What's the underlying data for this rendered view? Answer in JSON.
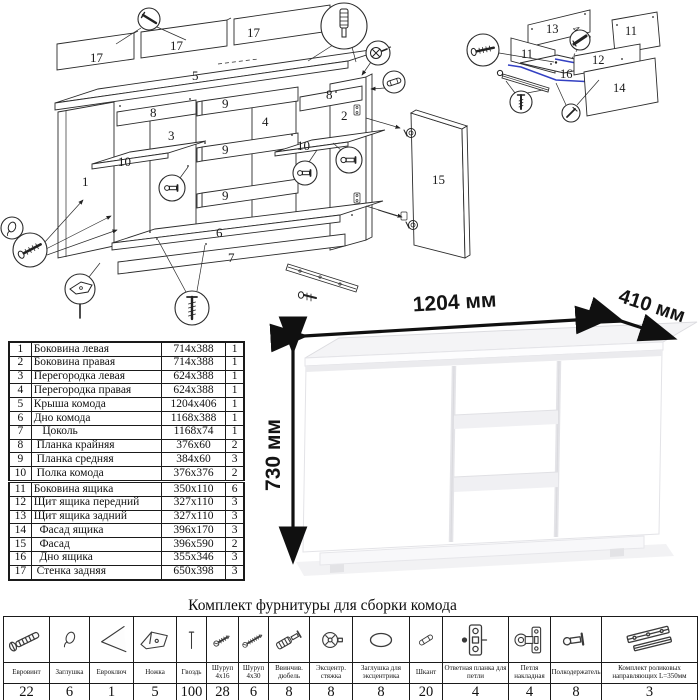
{
  "exploded_view": {
    "part_labels": {
      "back_a": "17",
      "back_b": "17",
      "back_c": "17",
      "top": "5",
      "side_left": "1",
      "side_right": "2",
      "partition_left": "3",
      "partition_right": "4",
      "bottom": "6",
      "plinth": "7",
      "bar_left": "8",
      "bar_right": "8",
      "rail_a": "9",
      "rail_b": "9",
      "rail_c": "9",
      "shelf_left": "10",
      "shelf_right": "10",
      "door": "15"
    },
    "callout_icons": [
      "nail-icon",
      "threaded-dowel-icon",
      "eccentric-cam-icon",
      "wood-dowel-icon",
      "shelf-pin-icon",
      "cap-icon",
      "euro-screw-icon",
      "foot-icon",
      "screw-icon",
      "roller-rail-icon",
      "hinge-icon"
    ]
  },
  "drawer_view": {
    "part_labels": {
      "back": "13",
      "side_left": "11",
      "side_right": "11",
      "front_shield": "12",
      "bottom": "16",
      "facade": "14"
    },
    "screw_note": "4х30",
    "accent_color": "#3340c2",
    "callout_icons": [
      "euro-screw-icon",
      "screw-icon",
      "nail-icon",
      "roller-rail-icon"
    ]
  },
  "render": {
    "width_label": "1204 мм",
    "depth_label": "410 мм",
    "height_label": "730 мм"
  },
  "parts_table": {
    "rows": [
      [
        "1",
        "Боковина левая",
        "714x388",
        "1"
      ],
      [
        "2",
        "Боковина правая",
        "714x388",
        "1"
      ],
      [
        "3",
        "Перегородка левая",
        "624x388",
        "1"
      ],
      [
        "4",
        "Перегородка правая",
        "624x388",
        "1"
      ],
      [
        "5",
        "Крыша комода",
        "1204x406",
        "1"
      ],
      [
        "6",
        "Дно комода",
        "1168x388",
        "1"
      ],
      [
        "7",
        "   Цоколь",
        "1168x74",
        "1"
      ],
      [
        "8",
        " Планка крайняя",
        "376x60",
        "2"
      ],
      [
        "9",
        " Планка средняя",
        "384x60",
        "3"
      ],
      [
        "10",
        " Полка комода",
        "376x376",
        "2"
      ],
      [
        "11",
        "Боковина ящика",
        "350x110",
        "6"
      ],
      [
        "12",
        "Щит ящика передний",
        "327x110",
        "3"
      ],
      [
        "13",
        "Щит ящика задний",
        "327x110",
        "3"
      ],
      [
        "14",
        "  Фасад ящика",
        "396x170",
        "3"
      ],
      [
        "15",
        "  Фасад",
        "396x590",
        "2"
      ],
      [
        "16",
        "  Дно ящика",
        "355x346",
        "3"
      ],
      [
        "17",
        " Стенка задняя",
        "650x398",
        "3"
      ]
    ]
  },
  "hardware": {
    "title": "Комплект фурнитуры для сборки комода",
    "items": [
      {
        "icon": "euro-screw-icon",
        "label": "Евровинт",
        "qty": "22"
      },
      {
        "icon": "cap-icon",
        "label": "Заглушка",
        "qty": "6"
      },
      {
        "icon": "hex-key-icon",
        "label": "Евроключ",
        "qty": "1"
      },
      {
        "icon": "foot-icon",
        "label": "Ножка",
        "qty": "5"
      },
      {
        "icon": "nail-icon",
        "label": "Гвоздь",
        "qty": "100"
      },
      {
        "icon": "screw-4x16-icon",
        "label": "Шуруп 4х16",
        "qty": "28"
      },
      {
        "icon": "screw-4x30-icon",
        "label": "Шуруп 4х30",
        "qty": "6"
      },
      {
        "icon": "threaded-dowel-icon",
        "label": "Ввинчив. дюбель",
        "qty": "8"
      },
      {
        "icon": "eccentric-cam-icon",
        "label": "Эксцентр. стяжка",
        "qty": "8"
      },
      {
        "icon": "eccentric-cap-icon",
        "label": "Заглушка для эксцентрика",
        "qty": "8"
      },
      {
        "icon": "wood-dowel-icon",
        "label": "Шкант",
        "qty": "20"
      },
      {
        "icon": "hinge-plate-icon",
        "label": "Ответная планка для петли",
        "qty": "4"
      },
      {
        "icon": "hinge-icon",
        "label": "Петля накладная",
        "qty": "4"
      },
      {
        "icon": "shelf-pin-icon",
        "label": "Полкодержатель",
        "qty": "8"
      },
      {
        "icon": "roller-rails-icon",
        "label": "Комплект роликовых направляющих L=350мм",
        "qty": "3"
      }
    ]
  }
}
